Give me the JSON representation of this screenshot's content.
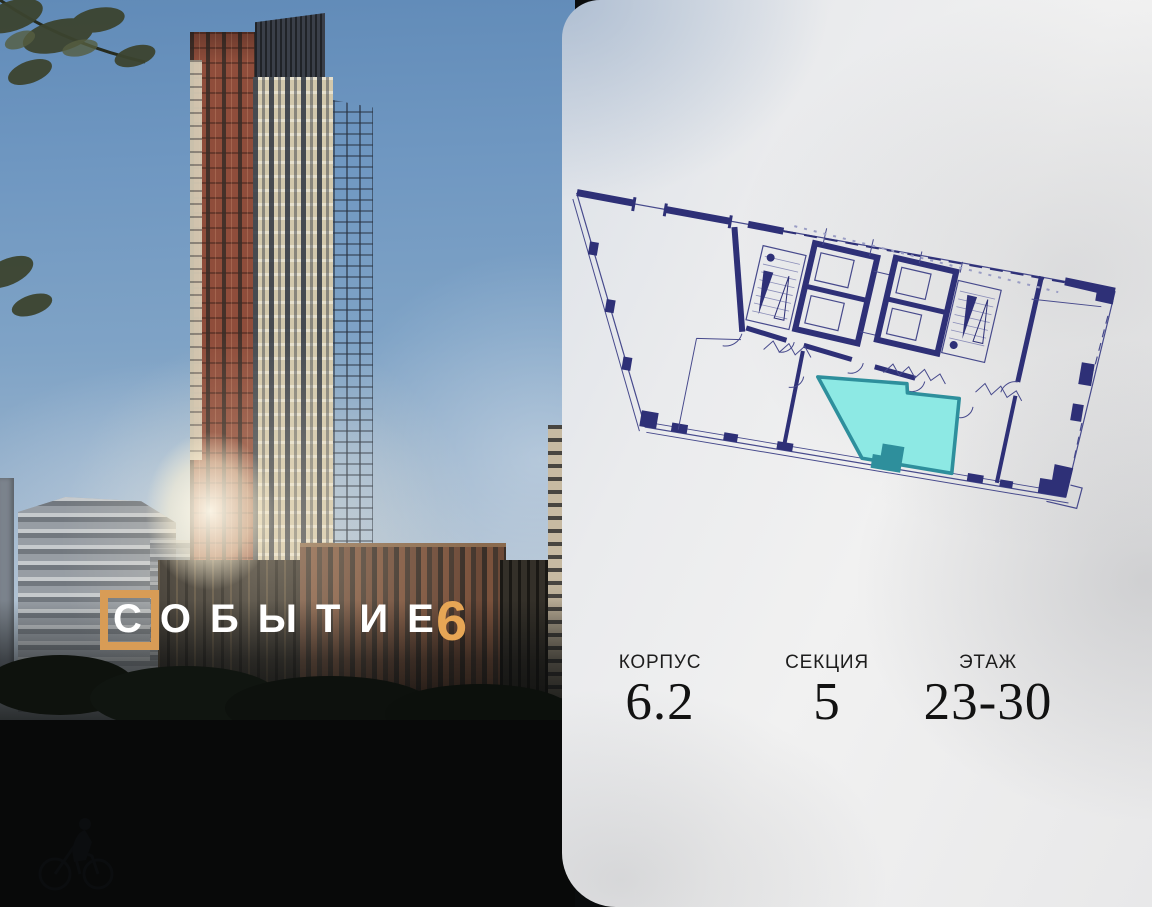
{
  "logo": {
    "letter_first": "С",
    "letters_rest": "ОБЫТИЕ",
    "number": "6",
    "accent_color": "#D89C56"
  },
  "card": {
    "details": {
      "items": [
        {
          "label": "КОРПУС",
          "value": "6.2"
        },
        {
          "label": "СЕКЦИЯ",
          "value": "5"
        },
        {
          "label": "ЭТАЖ",
          "value": "23-30"
        }
      ]
    }
  },
  "floor_plan": {
    "wall_color": "#2E3077",
    "thin_line_color": "#474A8C",
    "highlight_fill": "#8DE9E4",
    "highlight_border": "#2E8F9C"
  }
}
